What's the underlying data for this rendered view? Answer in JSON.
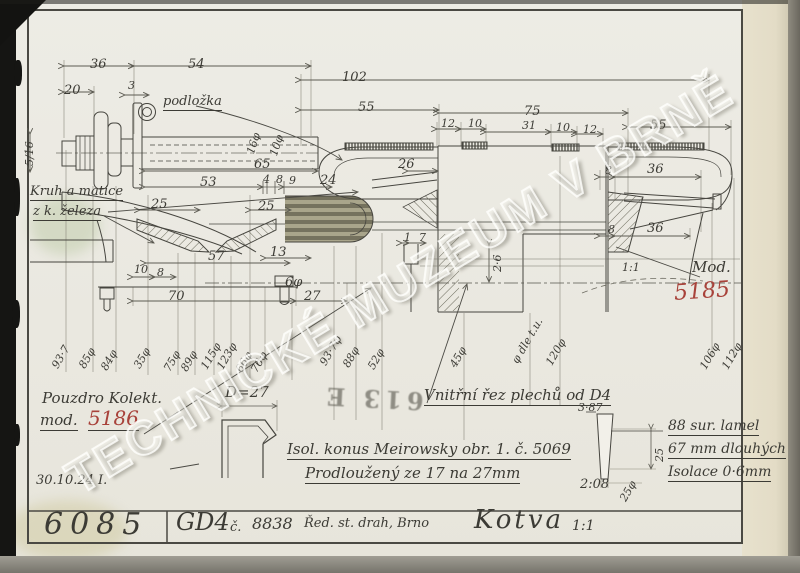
{
  "watermark": "TECHNICKÉ MUZEUM V BRNĚ",
  "stamp": "613 E",
  "title_block": {
    "drawing_number": "6085",
    "machine": "GD4",
    "number_label": "č.",
    "serial": "8838",
    "authority": "Řed. st. drah, Brno",
    "part_name": "Kotva",
    "scale": "1:1"
  },
  "notes": {
    "podlozka": "podložka",
    "kruh_1": "Kruh a matice",
    "kruh_2": "z k. železa",
    "pouzdro_1": "Pouzdro Kolekt.",
    "pouzdro_2": "mod.",
    "pouzdro_mod": "5186",
    "date": "30.10.24 I.",
    "d27": "D=27",
    "vnitrni": "Vnitřní řez plechů od D4",
    "isol": "Isol. konus Meirowsky obr. 1. č. 5069",
    "prodlouzeny": "Prodloužený ze 17 na 27mm",
    "mod_label": "Mod.",
    "mod_value": "5185",
    "lamel_1": "88 sur. lamel",
    "lamel_2": "67 mm dlouhých",
    "lamel_3": "Isolace 0·6mm"
  },
  "dims": [
    "36",
    "54",
    "20",
    "3",
    "102",
    "55",
    "75",
    "55",
    "12",
    "10",
    "31",
    "10",
    "12",
    "5/16",
    "16φ",
    "10φ",
    "65",
    "53",
    "4",
    "8",
    "9",
    "24",
    "26",
    "8",
    "36",
    "25",
    "25",
    "8",
    "36",
    "13",
    "57",
    "1",
    "7",
    "2·6",
    "10",
    "8",
    "70",
    "6φ",
    "27",
    "1:1",
    "93·7",
    "85φ",
    "84φ",
    "35φ",
    "75φ",
    "89φ",
    "115φ",
    "123φ",
    "66φ",
    "76φ",
    "93·7φ",
    "88φ",
    "52φ",
    "45φ",
    "φ dle t.u.",
    "120φ",
    "106φ",
    "112φ",
    "3·87",
    "2:08",
    "25",
    "25φ"
  ]
}
